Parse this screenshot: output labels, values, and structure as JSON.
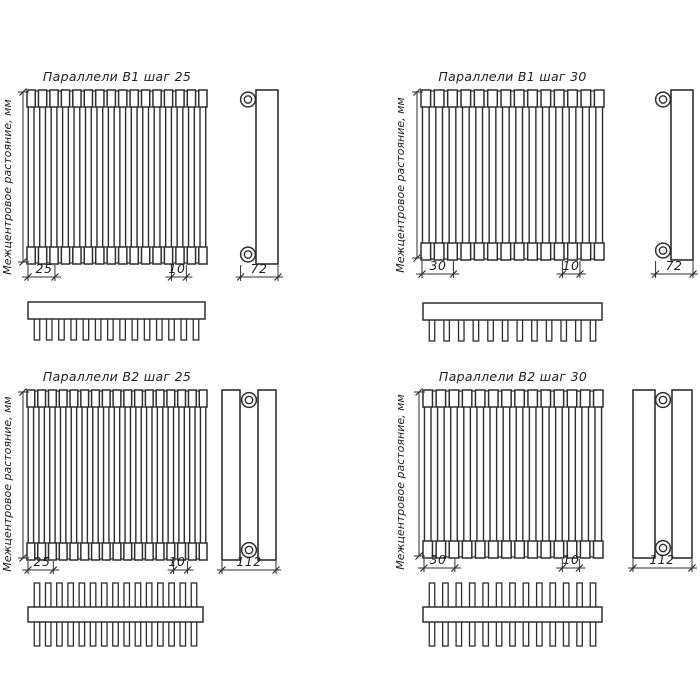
{
  "page": {
    "background": "#ffffff",
    "line_color": "#2e2e2e",
    "text_color": "#1e1e1e"
  },
  "axis_label": "Межцентровое растояние, мм",
  "quadrants": [
    {
      "id": "b1-step-25",
      "title": "Параллели В1 шаг 25",
      "row_type": "B1",
      "dims": {
        "step": "25",
        "tube_width": "10",
        "depth": "72"
      },
      "front_tube_count": 16,
      "comb_tooth_count": 14
    },
    {
      "id": "b1-step-30",
      "title": "Параллели В1 шаг 30",
      "row_type": "B1",
      "dims": {
        "step": "30",
        "tube_width": "10",
        "depth": "72"
      },
      "front_tube_count": 14,
      "comb_tooth_count": 12
    },
    {
      "id": "b2-step-25",
      "title": "Параллели В2 шаг 25",
      "row_type": "B2",
      "dims": {
        "step": "25",
        "tube_width": "10",
        "depth": "112"
      },
      "front_tube_count": 17,
      "comb_tooth_count": 15
    },
    {
      "id": "b2-step-30",
      "title": "Параллели В2 шаг 30",
      "row_type": "B2",
      "dims": {
        "step": "30",
        "tube_width": "10",
        "depth": "112"
      },
      "front_tube_count": 14,
      "comb_tooth_count": 13
    }
  ]
}
